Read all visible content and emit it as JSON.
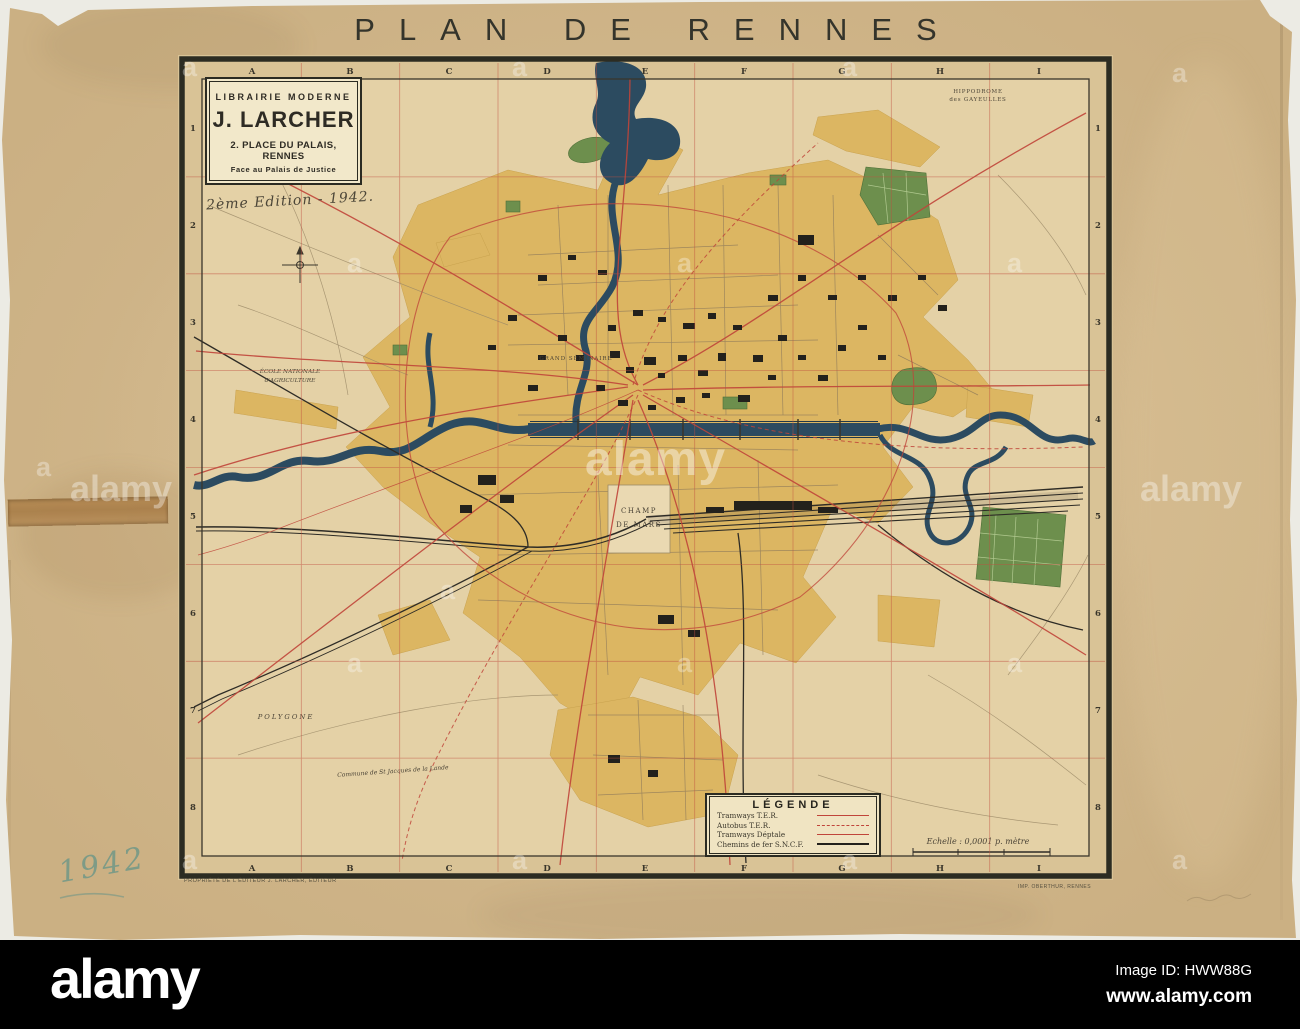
{
  "title": "PLAN DE RENNES",
  "cartouche": {
    "line1": "LIBRAIRIE  MODERNE",
    "name": "J. LARCHER",
    "address": "2. PLACE DU PALAIS, RENNES",
    "address2": "Face au Palais de Justice",
    "edition_note": "2ème Edition - 1942."
  },
  "grid": {
    "cols": [
      "A",
      "B",
      "C",
      "D",
      "E",
      "F",
      "G",
      "H",
      "I"
    ],
    "rows": [
      "1",
      "2",
      "3",
      "4",
      "5",
      "6",
      "7",
      "8"
    ]
  },
  "legend": {
    "title": "LÉGENDE",
    "items": [
      {
        "label": "Tramways T.E.R.",
        "style": "red-solid"
      },
      {
        "label": "Autobus T.E.R.",
        "style": "red-dashed"
      },
      {
        "label": "Tramways Déptale",
        "style": "red-thin"
      },
      {
        "label": "Chemins de fer S.N.C.F.",
        "style": "black-solid"
      }
    ]
  },
  "scale_label": "Echelle : 0,0001 p. mètre",
  "map_labels": {
    "champ_de_mars_1": "CHAMP",
    "champ_de_mars_2": "DE  MARS",
    "polygone": "POLYGONE",
    "grand_seminaire": "GRAND SÉMINAIRE",
    "ecole_1": "ÉCOLE NATIONALE",
    "ecole_2": "d'AGRICULTURE",
    "hippodrome_1": "HIPPODROME",
    "hippodrome_2": "des GAYEULLES",
    "commune": "Commune de St Jacques de la Lande"
  },
  "handwritten_year": "1942",
  "imprint_left": "PROPRIÉTÉ DE L'ÉDITEUR  J. LARCHER, ÉDITEUR",
  "imprint_right": "IMP. OBERTHUR, RENNES",
  "watermark": {
    "brand": "alamy",
    "ghost": "a"
  },
  "footer": {
    "logo": "alamy",
    "image_id": "Image ID: HWW88G",
    "website": "www.alamy.com"
  },
  "colors": {
    "paper": "#d6bd93",
    "map_background": "#e4d1a6",
    "built_area": "#dcb662",
    "water": "#2c4b60",
    "park": "#6d8f4d",
    "road_red": "#c0453a",
    "rail_black": "#2e2c26",
    "frame": "#2c2c22",
    "handwriting_green": "#7e9b86",
    "footer_bg": "#000000"
  }
}
